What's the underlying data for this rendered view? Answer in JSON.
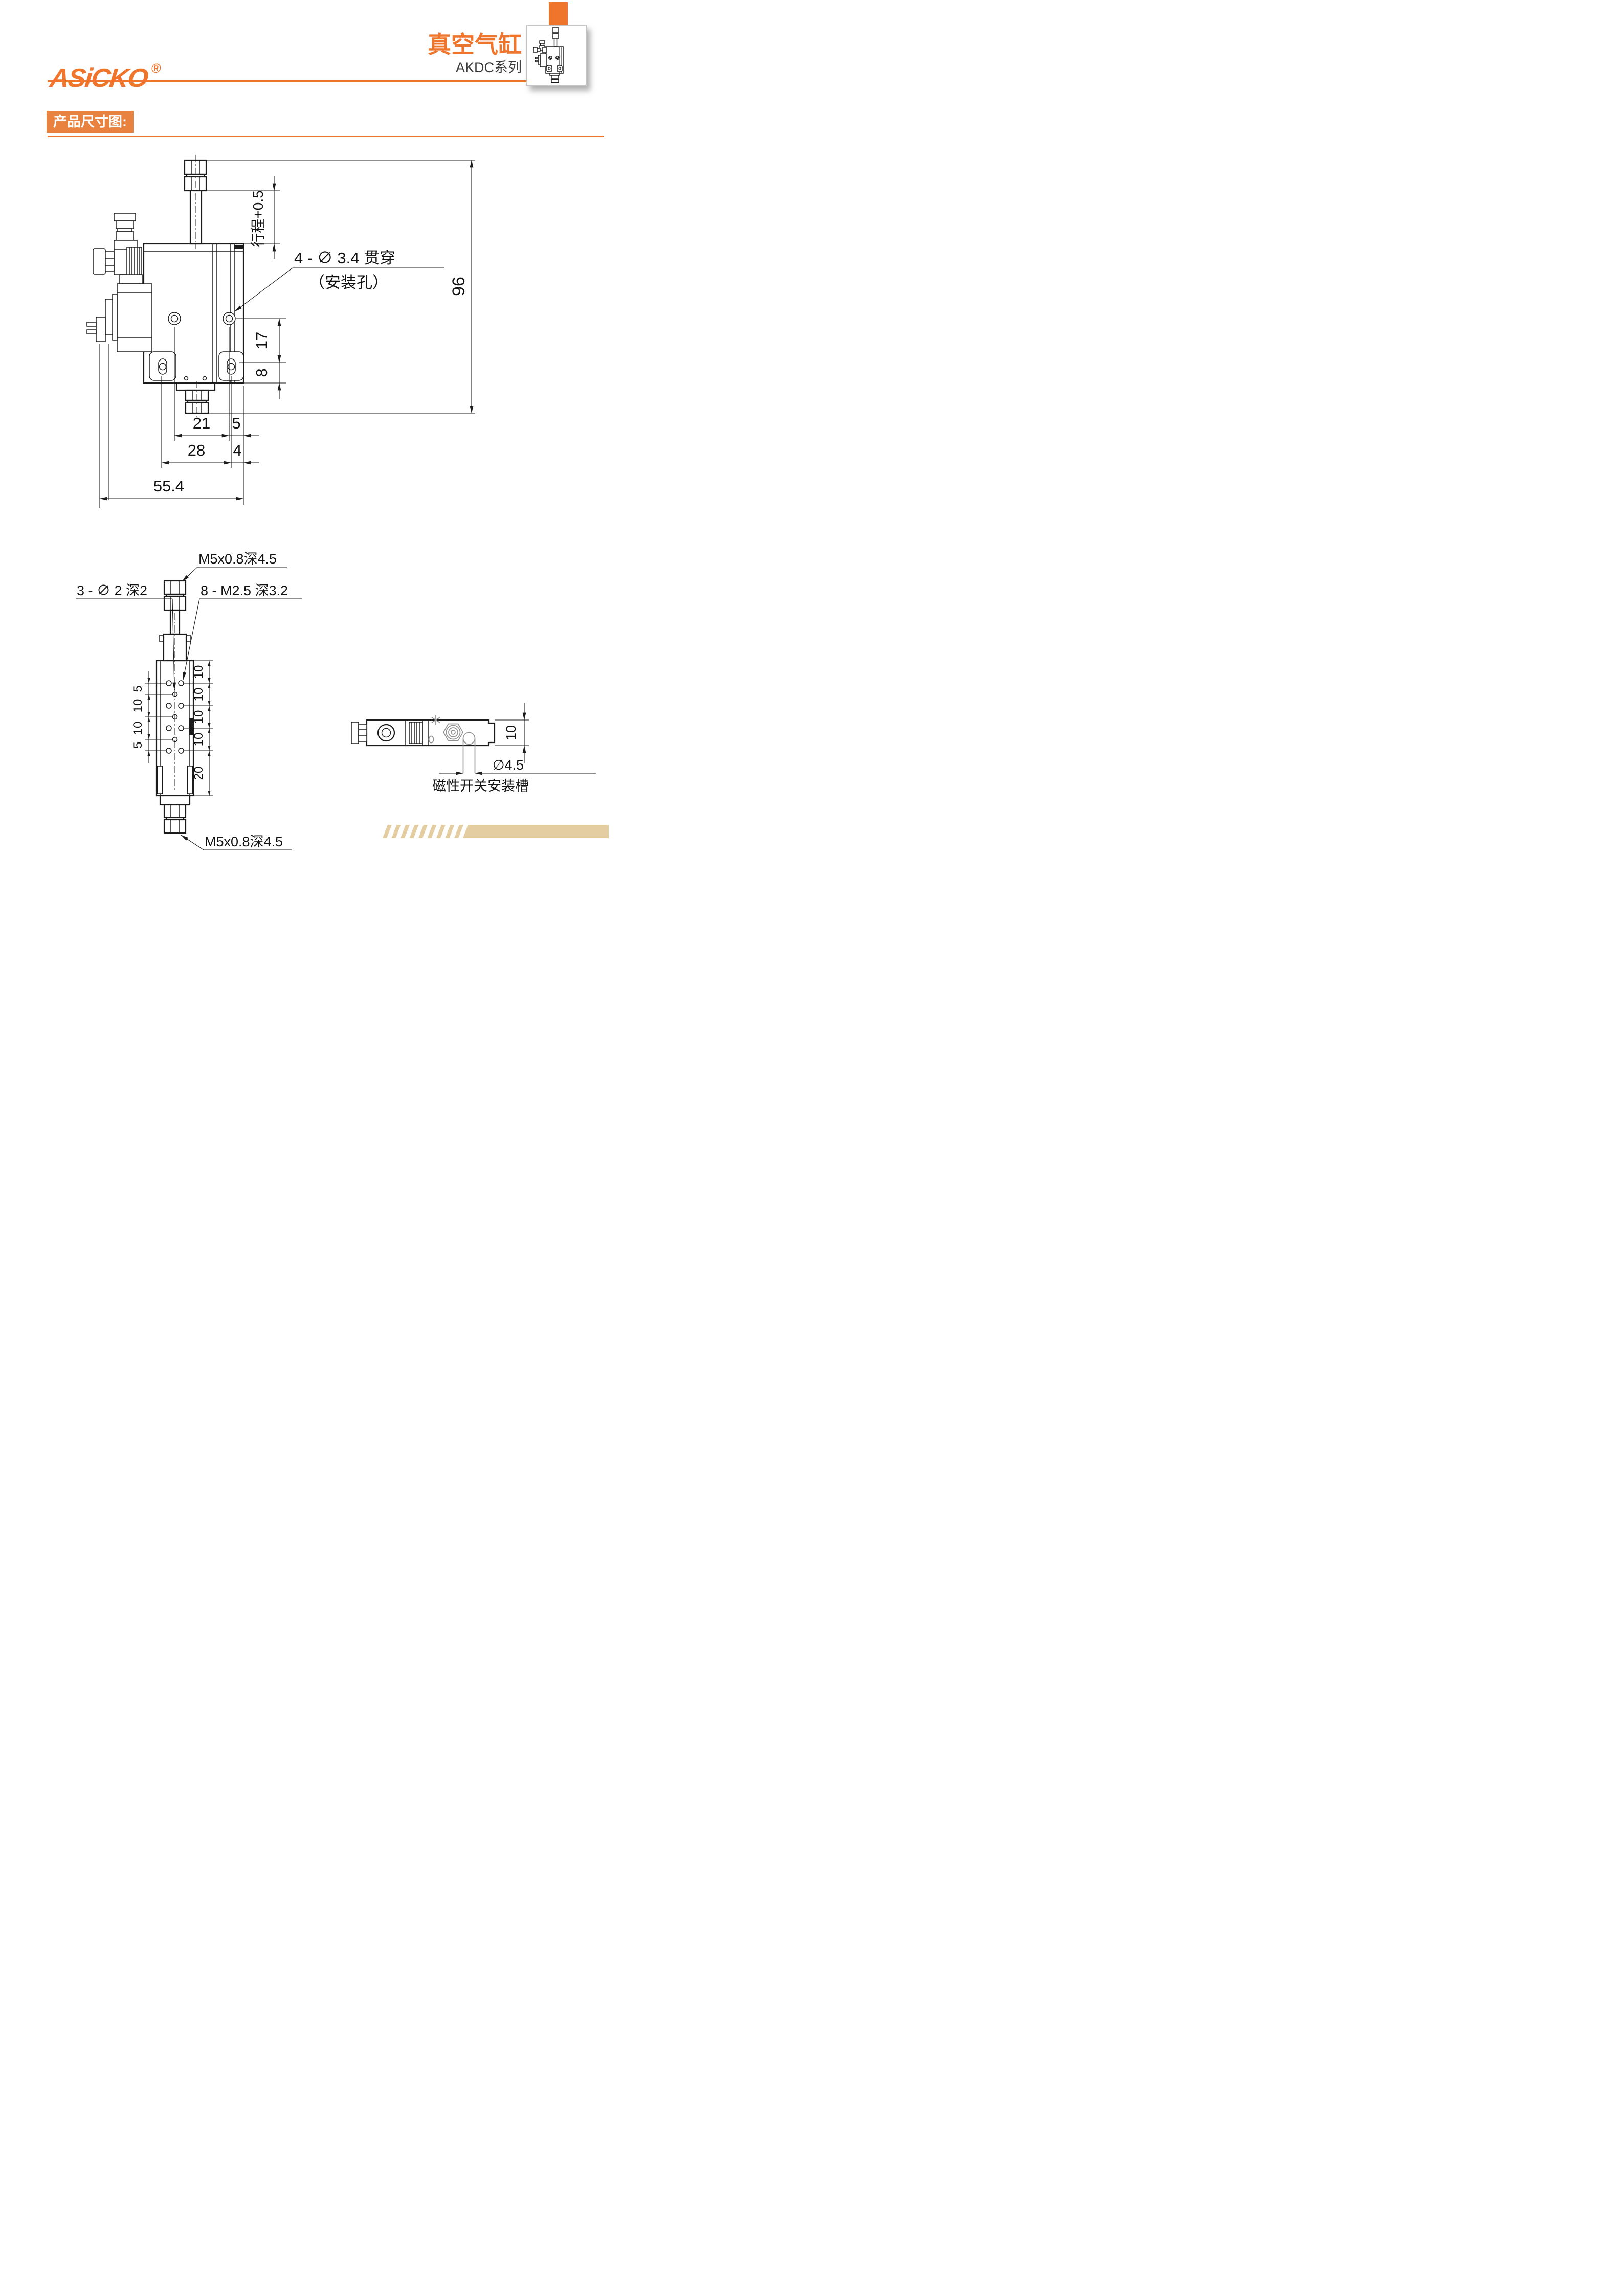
{
  "header": {
    "brand": "ASiCKO",
    "registered": "®",
    "title": "真空气缸",
    "series": "AKDC系列"
  },
  "section": {
    "label": "产品尺寸图:"
  },
  "colors": {
    "accent_orange": "#F0752C",
    "label_orange": "#E8823E",
    "stripe_tan": "#E3CDA1",
    "line_black": "#1b1b1b",
    "detail_gray": "#909090"
  },
  "main_view": {
    "stroke_label": "行程+0.5",
    "overall_height": "96",
    "hole_note": "4 - ∅ 3.4 贯穿",
    "hole_note_sub": "（安装孔）",
    "dim_17": "17",
    "dim_8": "8",
    "dim_21": "21",
    "dim_5": "5",
    "dim_28": "28",
    "dim_4": "4",
    "dim_55_4": "55.4"
  },
  "front_view": {
    "top_thread": "M5x0.8深4.5",
    "bottom_thread": "M5x0.8深4.5",
    "pin_holes_note": "3 - ∅ 2 深2",
    "thread_holes_note": "8 - M2.5 深3.2",
    "left_dims": [
      "5",
      "10",
      "10",
      "5"
    ],
    "right_dims": [
      "10",
      "10",
      "10",
      "10",
      "20"
    ]
  },
  "top_view": {
    "body_height": "10",
    "slot_dia": "∅4.5",
    "slot_label": "磁性开关安装槽"
  }
}
